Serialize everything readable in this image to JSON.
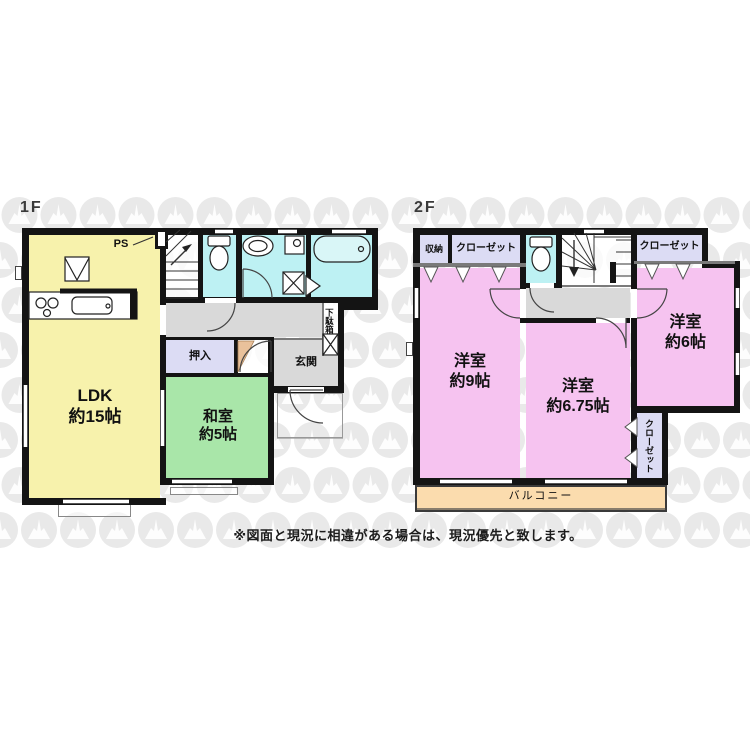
{
  "title": {
    "floor1": "1F",
    "floor2": "2F"
  },
  "disclaimer": "※図面と現況に相違がある場合は、現況優先と致します。",
  "floor1": {
    "ldk": {
      "name": "LDK",
      "size": "約15帖"
    },
    "washitsu": {
      "name": "和室",
      "size": "約5帖"
    },
    "oshiire": "押入",
    "genkan": "玄関",
    "getabako": "下駄箱",
    "ps": "PS"
  },
  "floor2": {
    "room9": {
      "name": "洋室",
      "size": "約9帖"
    },
    "room675": {
      "name": "洋室",
      "size": "約6.75帖"
    },
    "room6": {
      "name": "洋室",
      "size": "約6帖"
    },
    "shuno": "収納",
    "closet_top_left": "クローゼット",
    "closet_top_right": "クローゼット",
    "closet_side": "クローゼット",
    "balcony": "バルコニー"
  },
  "colors": {
    "wall": "#141414",
    "ldk": "#f7f2ac",
    "washitsu": "#a9e6a9",
    "water": "#bdf1f3",
    "pink": "#f6c3f0",
    "lavender": "#dcdcf4",
    "balcony": "#fbdcae",
    "hall": "#d9d9d9",
    "tan": "#e9c19b",
    "watermark": "#e9e9e9",
    "plan_white": "rgba(255,255,255,0.78)"
  }
}
